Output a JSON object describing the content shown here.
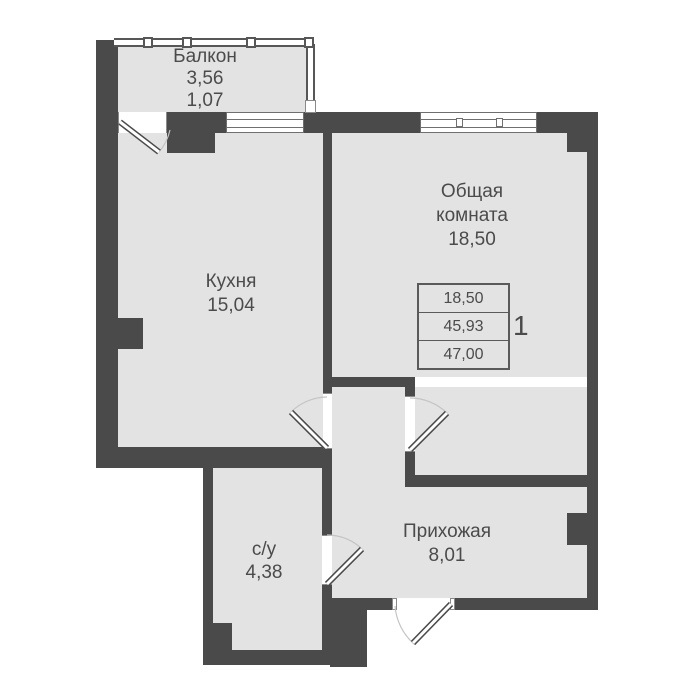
{
  "plan": {
    "title": "apartment-floor-plan",
    "rooms": {
      "balcony": {
        "name": "Балкон",
        "area_full": "3,56",
        "area_reduced": "1,07"
      },
      "kitchen": {
        "name": "Кухня",
        "area": "15,04"
      },
      "living": {
        "name_line1": "Общая",
        "name_line2": "комната",
        "area": "18,50"
      },
      "hallway": {
        "name": "Прихожая",
        "area": "8,01"
      },
      "bathroom": {
        "name": "с/у",
        "area": "4,38"
      }
    },
    "info_table": {
      "living_area": "18,50",
      "area_without_balcony": "45,93",
      "total_area": "47,00",
      "apartment_number": "1"
    },
    "colors": {
      "wall": "#4a4a4a",
      "floor": "#e3e3e3",
      "frame_outline": "#6f6f6f",
      "door_arc": "#c4c4c4",
      "text": "#4b4b4b"
    }
  }
}
